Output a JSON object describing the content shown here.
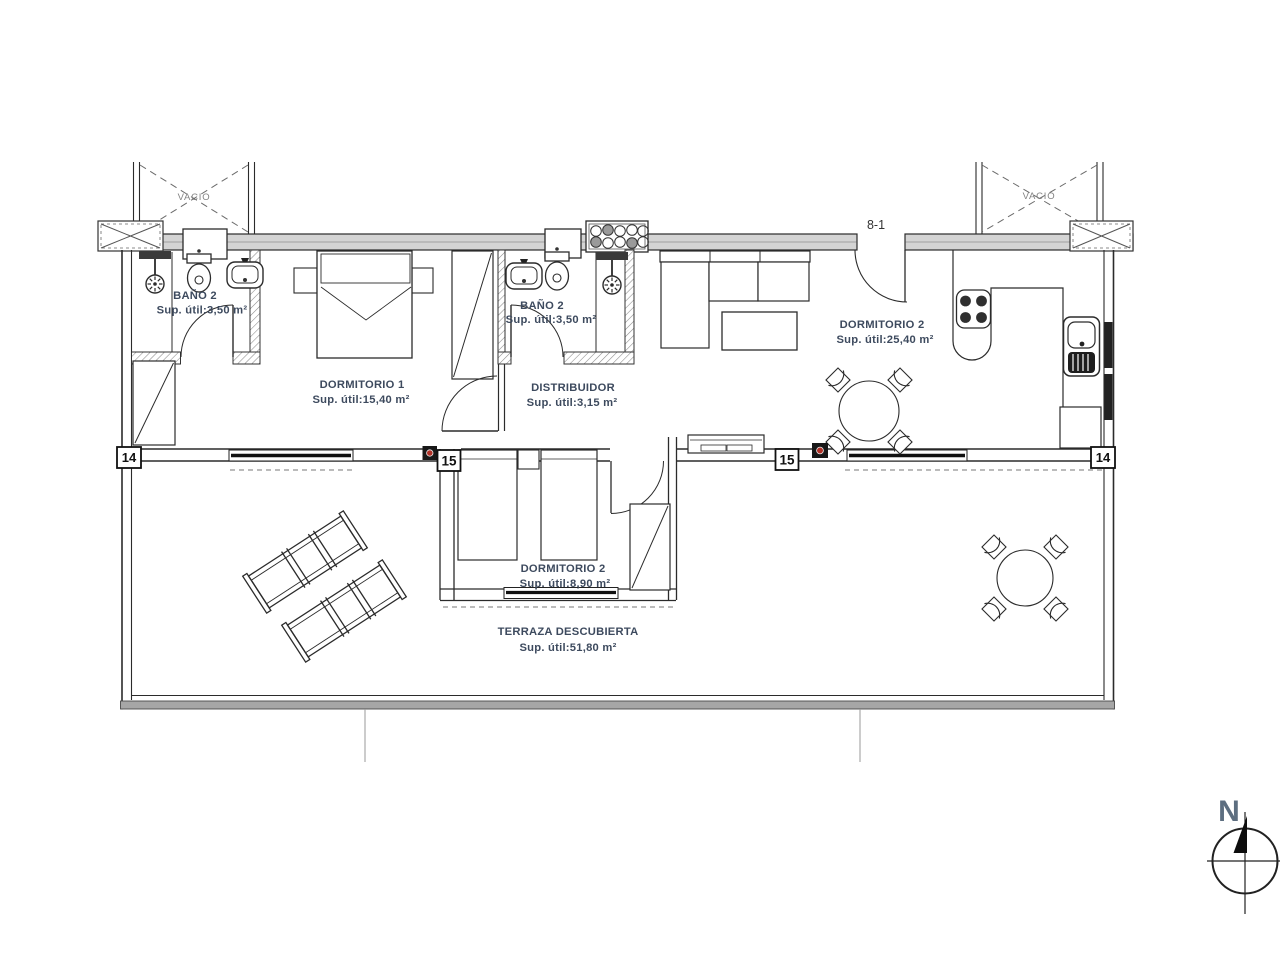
{
  "plan": {
    "rooms": {
      "bano2_left": {
        "name": "BAÑO 2",
        "area": "Sup. útil:3,50 m²"
      },
      "bano2_mid": {
        "name": "BAÑO 2",
        "area": "Sup. útil:3,50 m²"
      },
      "dormitorio1": {
        "name": "DORMITORIO 1",
        "area": "Sup. útil:15,40 m²"
      },
      "distribuidor": {
        "name": "DISTRIBUIDOR",
        "area": "Sup. útil:3,15 m²"
      },
      "dormitorio2_main": {
        "name": "DORMITORIO 2",
        "area": "Sup. útil:25,40 m²"
      },
      "dormitorio2_small": {
        "name": "DORMITORIO 2",
        "area": "Sup. útil:8,90 m²"
      },
      "terraza": {
        "name": "TERRAZA DESCUBIERTA",
        "area": "Sup. útil:51,80 m²"
      }
    },
    "voids": {
      "left": "VACIO",
      "right": "VACIO"
    },
    "markers": {
      "door_ref": "8-1",
      "left_14": "14",
      "right_14": "14",
      "left_15": "15",
      "right_15": "15"
    },
    "compass": {
      "north_label": "N"
    },
    "colors": {
      "line": "#2b2b2b",
      "label_text": "#3d4a5e",
      "muted_text": "#828282",
      "wall_fill": "#d4d4d4",
      "terrace_wall_fill": "#a6a6a6",
      "accent_red": "#b03026"
    }
  }
}
